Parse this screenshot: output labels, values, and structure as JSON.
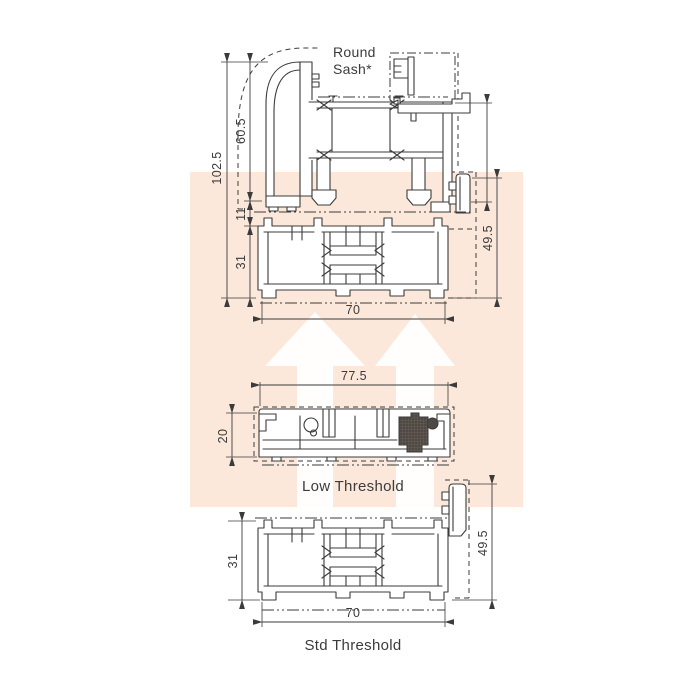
{
  "colors": {
    "line": "#3b3b3b",
    "peach": "#fbe8db",
    "watermark_arrow": "#ffffff",
    "gasket": "#4f4943"
  },
  "top_assembly": {
    "note_line1": "Round",
    "note_line2": "Sash*",
    "overall_height": "102.5",
    "sash_height": "60.5",
    "mid_gap": "11",
    "base_height": "31",
    "base_width": "70",
    "upstand_height": "49.5"
  },
  "low_threshold": {
    "label": "Low Threshold",
    "width": "77.5",
    "height": "20"
  },
  "std_threshold": {
    "label": "Std Threshold",
    "height": "31",
    "width": "70",
    "upstand_height": "49.5"
  }
}
